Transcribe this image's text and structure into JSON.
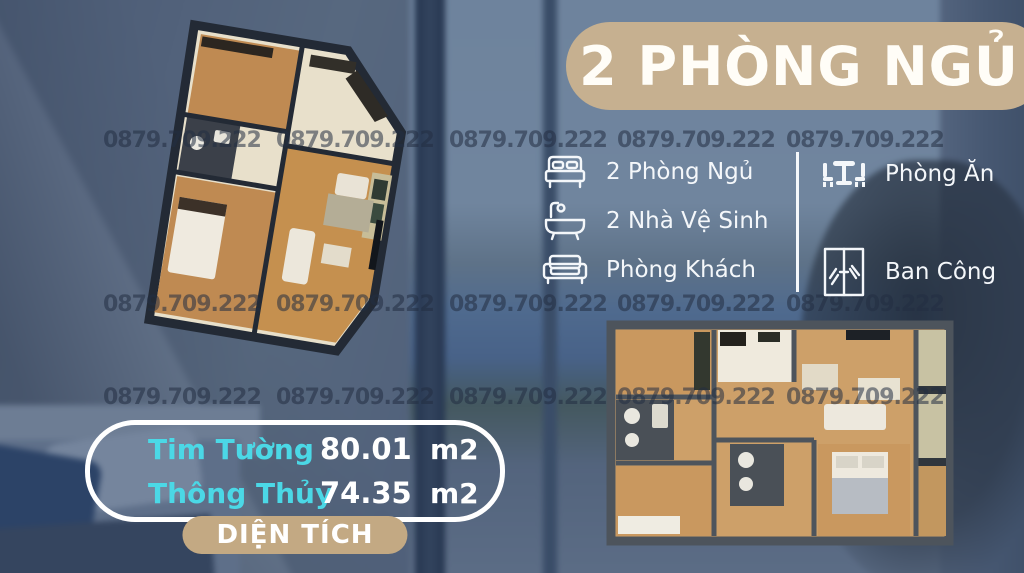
{
  "title": {
    "label": "2 PHÒNG NGỦ",
    "bg_color": "#c6b090",
    "text_color": "#fffdf7"
  },
  "watermark": {
    "text": "0879.709.222"
  },
  "features": {
    "left": [
      {
        "icon": "bed-icon",
        "label": "2 Phòng Ngủ"
      },
      {
        "icon": "bathtub-icon",
        "label": "2 Nhà Vệ Sinh"
      },
      {
        "icon": "sofa-icon",
        "label": "Phòng Khách"
      }
    ],
    "right": [
      {
        "icon": "dining-table-icon",
        "label": "Phòng Ăn"
      },
      {
        "icon": "balcony-window-icon",
        "label": "Ban Công"
      }
    ]
  },
  "area_box": {
    "rows": [
      {
        "label": "Tim Tường",
        "value": "80.01",
        "unit": "m2"
      },
      {
        "label": "Thông Thủy",
        "value": "74.35",
        "unit": "m2"
      }
    ],
    "badge": "DIỆN TÍCH",
    "label_color": "#4bd8e6",
    "badge_bg": "#c3a983"
  },
  "floor_plans": {
    "top_left_alt": "3D floor plan, rotated perspective view",
    "bottom_right_alt": "3D floor plan, straight top view"
  },
  "colors": {
    "accent_tan": "#c6b090",
    "accent_cyan": "#4bd8e6",
    "watermark": "rgba(34,46,65,0.55)"
  }
}
